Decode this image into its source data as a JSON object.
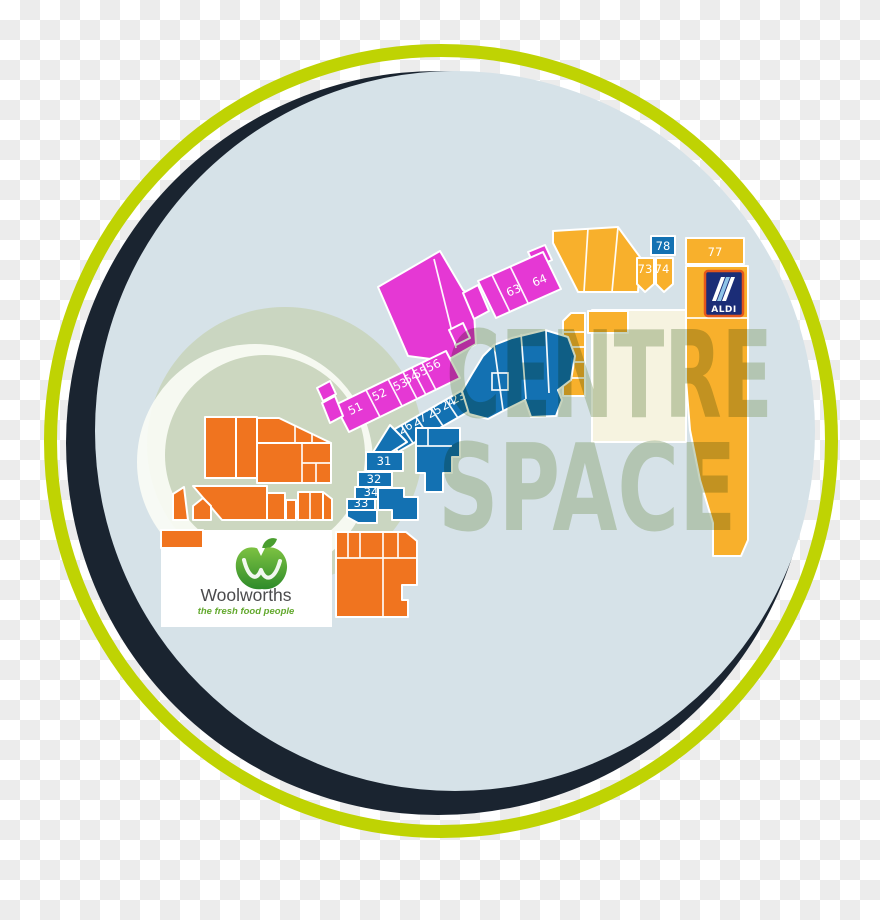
{
  "background": {
    "checker_light": "#ffffff",
    "checker_dark": "#ececec"
  },
  "rings": {
    "outer_color": "#bfd303",
    "shadow_color": "#1a2430",
    "map_bg": "#d6e2e8"
  },
  "watermark": {
    "line1": "CENTRE",
    "line2": "SPACE",
    "color": "#8ca678"
  },
  "palette": {
    "magenta": "#e538d4",
    "blue": "#1371b2",
    "orange": "#f0741f",
    "amber": "#f8b02c",
    "cream": "#f6f3e0",
    "sage": "#c8d4ba",
    "swoosh": "#fbfdf6",
    "white": "#ffffff"
  },
  "units": [
    {
      "label": "51",
      "x": 357,
      "y": 412,
      "rotate": -25
    },
    {
      "label": "52",
      "x": 381,
      "y": 398,
      "rotate": -25
    },
    {
      "label": "53",
      "x": 402,
      "y": 388,
      "rotate": -25
    },
    {
      "label": "54",
      "x": 413,
      "y": 381,
      "rotate": -25
    },
    {
      "label": "55",
      "x": 422,
      "y": 376,
      "rotate": -25
    },
    {
      "label": "56",
      "x": 435,
      "y": 369,
      "rotate": -25
    },
    {
      "label": "63",
      "x": 515,
      "y": 294,
      "rotate": -22
    },
    {
      "label": "64",
      "x": 541,
      "y": 284,
      "rotate": -22
    },
    {
      "label": "26",
      "x": 407,
      "y": 431,
      "rotate": -28
    },
    {
      "label": "27",
      "x": 421,
      "y": 423,
      "rotate": -28
    },
    {
      "label": "25",
      "x": 436,
      "y": 415,
      "rotate": -28
    },
    {
      "label": "24",
      "x": 450,
      "y": 407,
      "rotate": -28
    },
    {
      "label": "23",
      "x": 460,
      "y": 401,
      "rotate": -28
    },
    {
      "label": "31",
      "x": 384,
      "y": 465,
      "rotate": 0
    },
    {
      "label": "32",
      "x": 374,
      "y": 483,
      "rotate": 0
    },
    {
      "label": "34",
      "x": 371,
      "y": 496,
      "rotate": 0
    },
    {
      "label": "33",
      "x": 361,
      "y": 507,
      "rotate": 0
    },
    {
      "label": "73",
      "x": 645,
      "y": 273,
      "rotate": 0
    },
    {
      "label": "74",
      "x": 662,
      "y": 273,
      "rotate": 0
    },
    {
      "label": "78",
      "x": 663,
      "y": 250,
      "rotate": 0
    },
    {
      "label": "77",
      "x": 715,
      "y": 256,
      "rotate": 0
    }
  ],
  "anchors": {
    "woolworths": {
      "name": "Woolworths",
      "tagline": "the fresh food people"
    },
    "aldi": {
      "name": "ALDI"
    }
  }
}
